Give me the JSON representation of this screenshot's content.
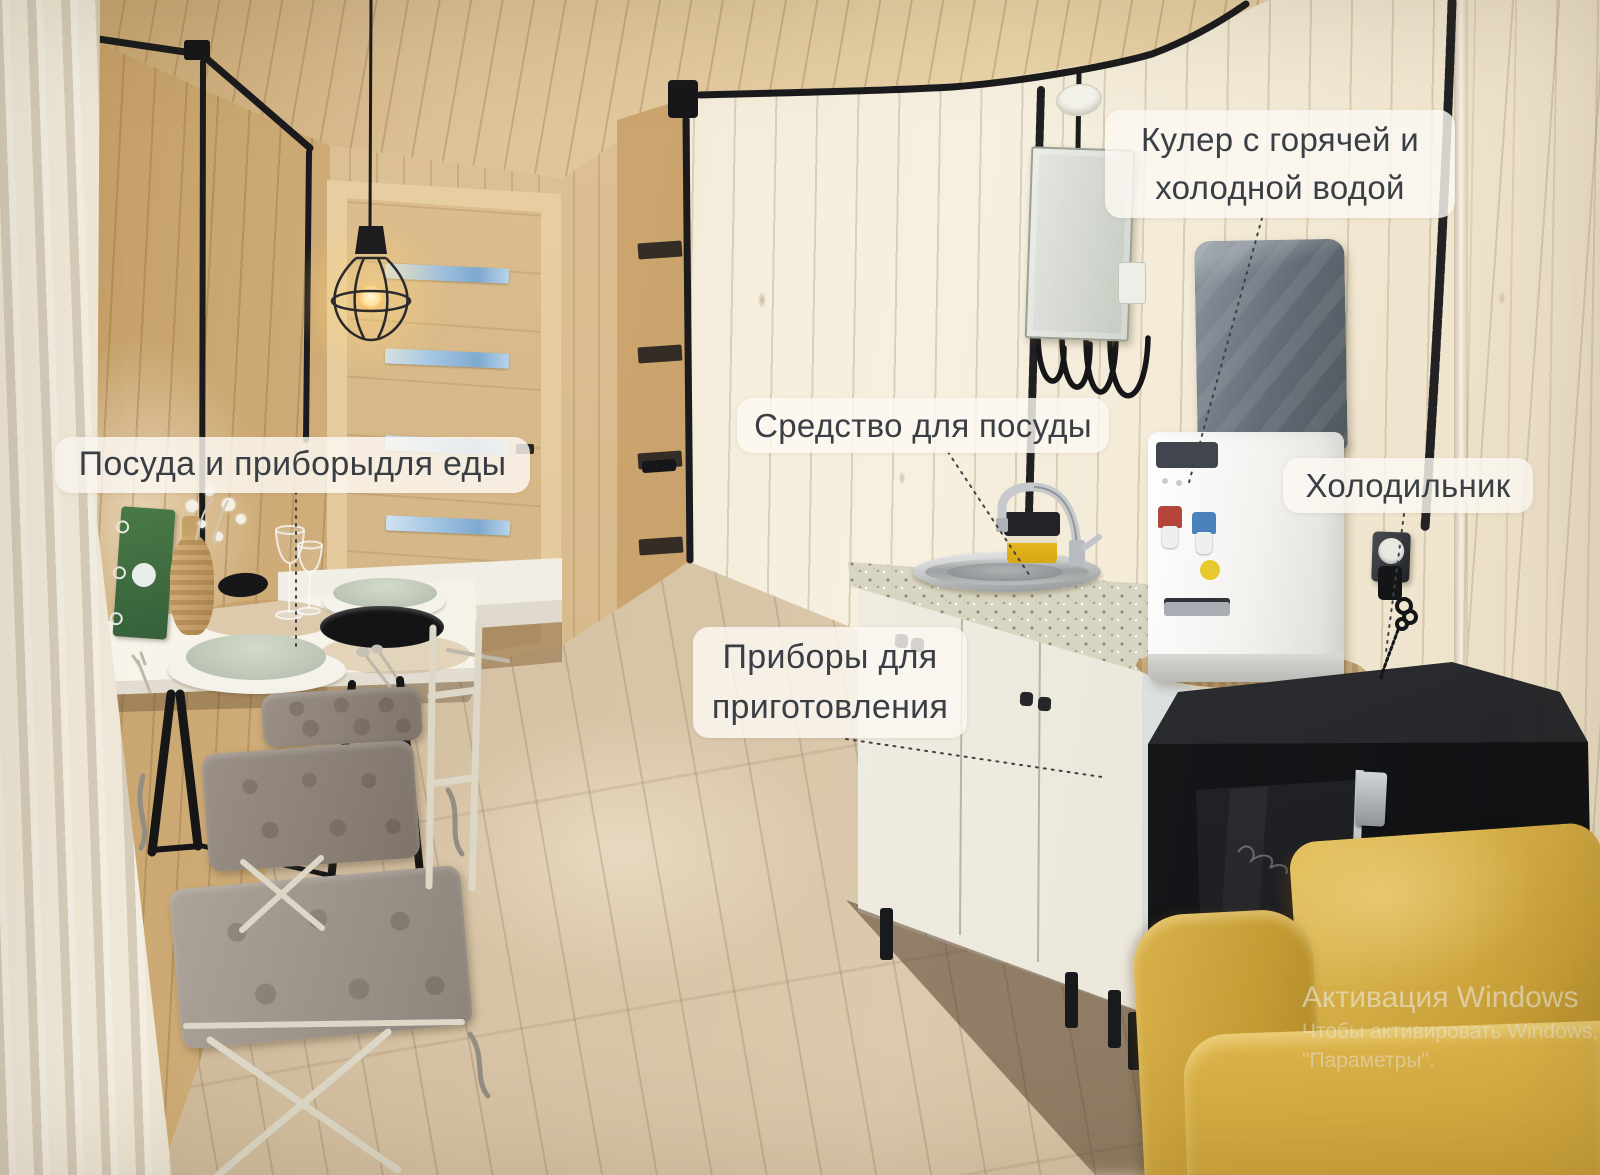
{
  "annotations": {
    "dishes": {
      "text": "Посуда и приборыдля еды"
    },
    "dish_soap": {
      "text": "Средство для посуды"
    },
    "water_cooler": {
      "line1": "Кулер с горячей и",
      "line2": "холодной водой"
    },
    "refrigerator": {
      "text": "Холодильник"
    },
    "cooking_utensils": {
      "line1": "Приборы для",
      "line2": "приготовления"
    }
  },
  "watermark": {
    "title": "Активация Windows",
    "subtitle": "Чтобы активировать Windows, пе",
    "subtitle2": "\"Параметры\"."
  },
  "colors": {
    "label_background": "rgba(253,249,243,0.82)",
    "label_text": "#3a3f45",
    "wood_wall_light": "#f2e9d8",
    "wood_floor": "#d6c2a4",
    "sofa_yellow": "#cfa843",
    "fridge_dark": "#1c1d21",
    "hot_tap_red": "#b5443a",
    "cold_tap_blue": "#4c82bb",
    "bottle_cover_gray": "#636c76",
    "watermark_text": "rgba(238,238,238,0.55)"
  }
}
